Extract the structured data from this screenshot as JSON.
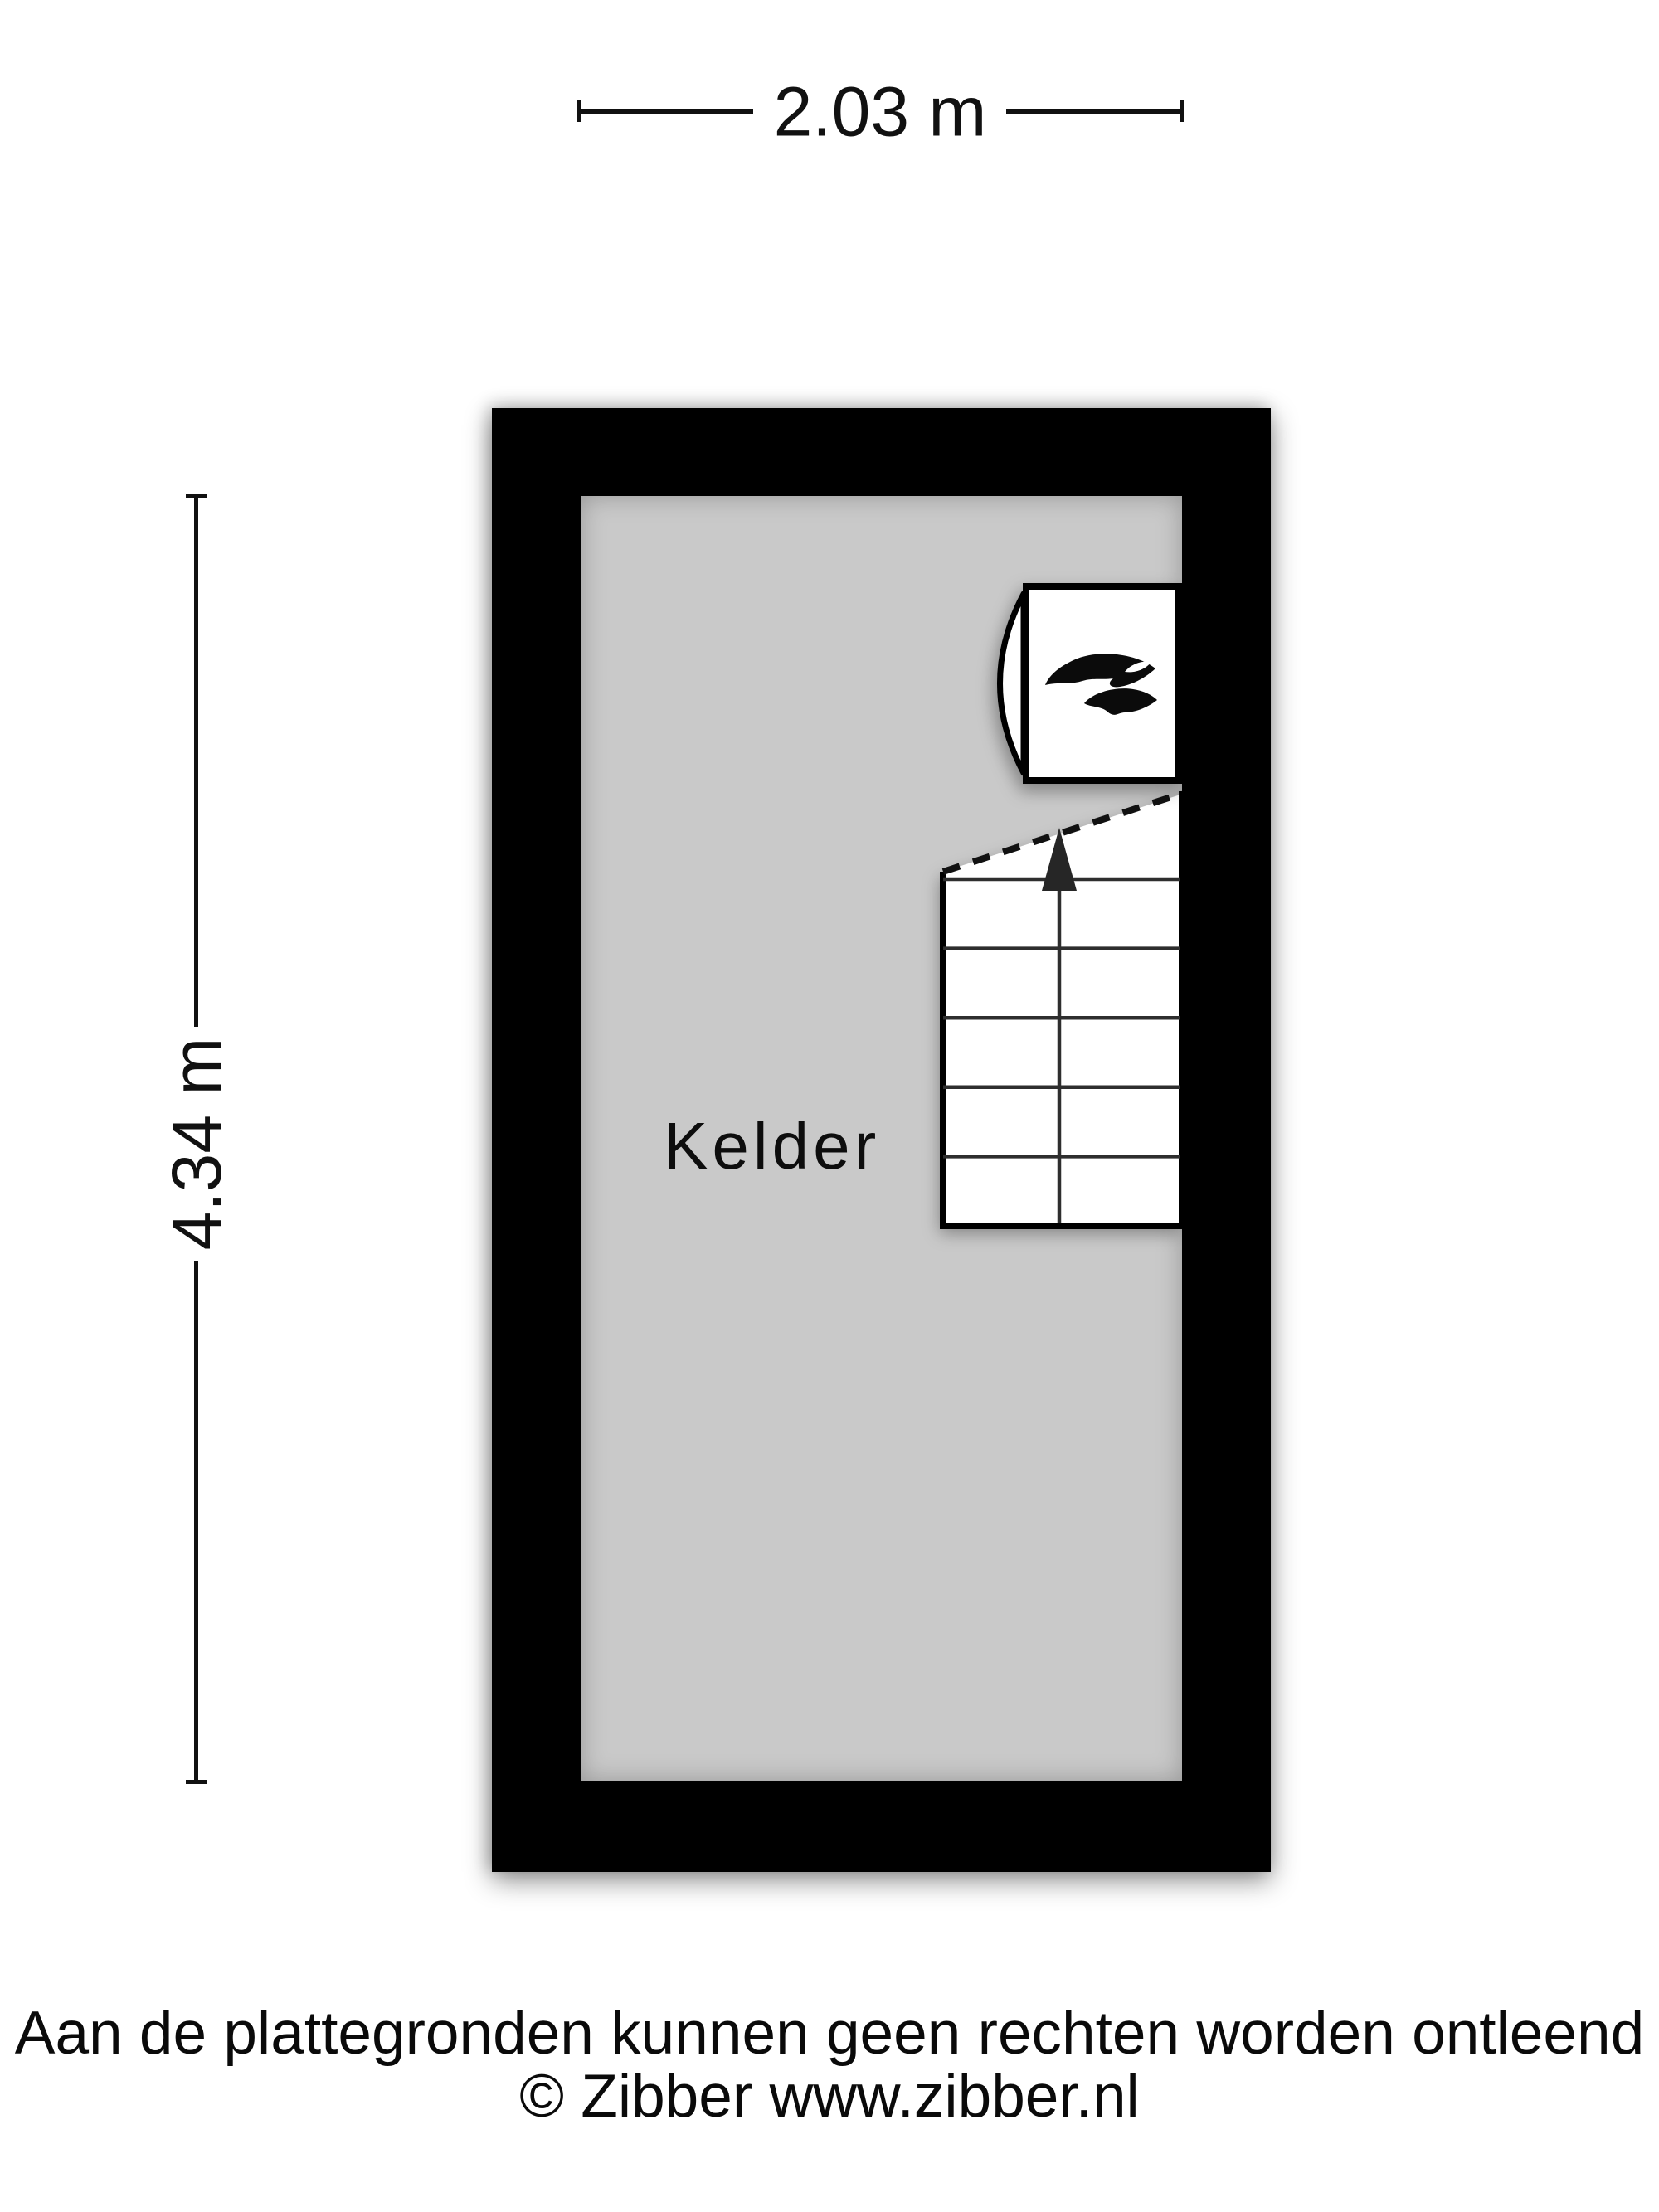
{
  "plan": {
    "room": {
      "name": "Kelder"
    },
    "features": {
      "stairs": {
        "direction": "up",
        "arrow_icon": "arrow-up-icon"
      },
      "boiler": {
        "icon": "flame-icon"
      }
    }
  },
  "dimensions": {
    "width": {
      "label": "2.03 m"
    },
    "height": {
      "label": "4.34 m"
    }
  },
  "footer": {
    "disclaimer": "Aan de plattegronden kunnen geen rechten worden ontleend",
    "copyright": "© Zibber www.zibber.nl"
  },
  "colors": {
    "wall": "#000000",
    "floor": "#c9c9c9",
    "background": "#ffffff",
    "ink": "#111111",
    "stair_fill": "#ffffff"
  }
}
